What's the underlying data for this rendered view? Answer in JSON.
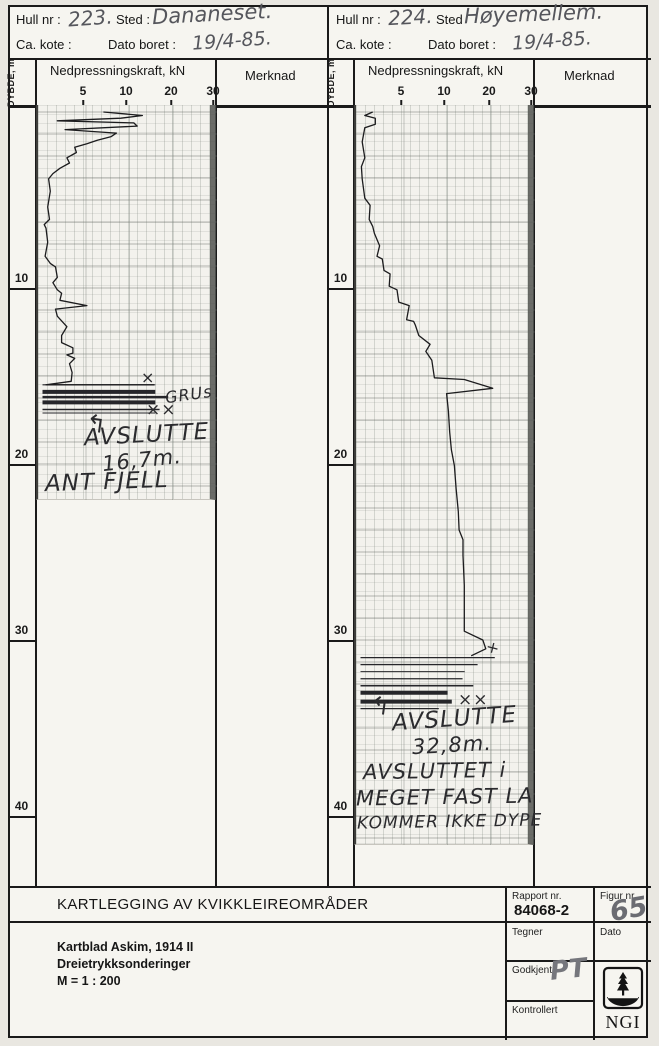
{
  "panels": [
    {
      "hull_nr_label": "Hull nr :",
      "hull_nr": "223.",
      "sted_label": "Sted :",
      "sted": "Dananeset.",
      "kote_label": "Ca. kote :",
      "dato_label": "Dato boret :",
      "dato": "19/4-85.",
      "depth_axis_label": "DYBDE, m",
      "force_label": "Nedpressningskraft, kN",
      "merknad_label": "Merknad",
      "force_ticks": [
        "5",
        "10",
        "20",
        "30"
      ],
      "depth_ticks": [
        "10",
        "20",
        "30",
        "40"
      ],
      "annotations": {
        "mark_x": "×",
        "soil": "GRUs",
        "mark_xx": "××",
        "arrow": "↰",
        "stop_word": "AVSLUTTE",
        "stop_depth": "16,7m.",
        "stop_note": "ANT FJELL"
      }
    },
    {
      "hull_nr_label": "Hull nr :",
      "hull_nr": "224.",
      "sted_label": "Sted",
      "sted": "Høyemellem.",
      "kote_label": "Ca. kote :",
      "dato_label": "Dato boret :",
      "dato": "19/4-85.",
      "depth_axis_label": "DYBDE, m",
      "force_label": "Nedpressningskraft, kN",
      "merknad_label": "Merknad",
      "force_ticks": [
        "5",
        "10",
        "20",
        "30"
      ],
      "depth_ticks": [
        "10",
        "20",
        "30",
        "40"
      ],
      "annotations": {
        "mark_plus": "+",
        "mark_xx": "××",
        "arrow": "↰",
        "stop_word": "AVSLUTTE",
        "stop_depth": "32,8m.",
        "stop_note1": "AVSLUTTET i",
        "stop_note2": "MEGET FAST LA",
        "stop_note3": "KOMMER IKKE DYPE"
      }
    }
  ],
  "chart_data": [
    {
      "type": "line",
      "title": "Dreietrykksondering Hull nr 223 Dananeset",
      "xlabel": "Nedpressningskraft, kN",
      "ylabel": "Dybde, m",
      "x_ticks": [
        5,
        10,
        20,
        30
      ],
      "xlim": [
        0,
        30
      ],
      "ylim": [
        0,
        22
      ],
      "grid": true,
      "points": [
        [
          7,
          0
        ],
        [
          13,
          0.2
        ],
        [
          9,
          0.35
        ],
        [
          1.7,
          0.5
        ],
        [
          11,
          0.62
        ],
        [
          11.8,
          0.8
        ],
        [
          2.6,
          1.0
        ],
        [
          8.5,
          1.2
        ],
        [
          7.9,
          1.4
        ],
        [
          6.3,
          1.6
        ],
        [
          5.1,
          1.8
        ],
        [
          3.7,
          2.0
        ],
        [
          3.9,
          2.3
        ],
        [
          2.8,
          2.6
        ],
        [
          3.1,
          2.9
        ],
        [
          2.0,
          3.2
        ],
        [
          1.2,
          3.5
        ],
        [
          0.7,
          3.8
        ],
        [
          0.9,
          4.5
        ],
        [
          0.6,
          5.4
        ],
        [
          0.8,
          6.1
        ],
        [
          0.2,
          6.4
        ],
        [
          0.4,
          6.6
        ],
        [
          0.6,
          7.4
        ],
        [
          0.3,
          8.2
        ],
        [
          0.9,
          8.6
        ],
        [
          1.5,
          8.8
        ],
        [
          1.7,
          9.4
        ],
        [
          1.2,
          9.7
        ],
        [
          1.7,
          10.1
        ],
        [
          2.2,
          10.3
        ],
        [
          2.0,
          10.7
        ],
        [
          5.1,
          11.0
        ],
        [
          1.5,
          11.2
        ],
        [
          1.7,
          11.6
        ],
        [
          2.8,
          12.2
        ],
        [
          2.2,
          12.7
        ],
        [
          2.2,
          13.1
        ],
        [
          3.5,
          13.4
        ],
        [
          3.5,
          13.7
        ],
        [
          2.8,
          13.8
        ],
        [
          3.7,
          14.0
        ],
        [
          3.1,
          14.3
        ],
        [
          3.4,
          14.8
        ],
        [
          3.3,
          15.3
        ],
        [
          0.4,
          15.5
        ],
        [
          15.7,
          15.5
        ]
      ],
      "hard_layers": [
        {
          "depth": 15.5,
          "kn": 16,
          "w": 1.2
        },
        {
          "depth": 15.9,
          "kn": 16,
          "w": 4
        },
        {
          "depth": 16.2,
          "kn": 19,
          "w": 2.5
        },
        {
          "depth": 16.5,
          "kn": 16,
          "w": 4
        },
        {
          "depth": 16.9,
          "kn": 17,
          "w": 1.5
        },
        {
          "depth": 17.1,
          "kn": 16,
          "w": 1
        }
      ],
      "end_depth_m": 16.7,
      "end_note": "ANT FJELL"
    },
    {
      "type": "line",
      "title": "Dreietrykksondering Hull nr 224 Høyemellem",
      "xlabel": "Nedpressningskraft, kN",
      "ylabel": "Dybde, m",
      "x_ticks": [
        5,
        10,
        20,
        30
      ],
      "xlim": [
        0,
        30
      ],
      "ylim": [
        0,
        42
      ],
      "grid": true,
      "points": [
        [
          1.4,
          0
        ],
        [
          0.5,
          0.2
        ],
        [
          1.7,
          0.35
        ],
        [
          1.7,
          0.7
        ],
        [
          0.5,
          0.9
        ],
        [
          0.2,
          1.7
        ],
        [
          0.5,
          2.6
        ],
        [
          0.1,
          3.1
        ],
        [
          0.2,
          3.8
        ],
        [
          0.5,
          4.9
        ],
        [
          1.1,
          5.3
        ],
        [
          1.0,
          6.1
        ],
        [
          1.4,
          6.5
        ],
        [
          1.6,
          6.9
        ],
        [
          2.2,
          7.6
        ],
        [
          1.9,
          8.2
        ],
        [
          2.5,
          8.35
        ],
        [
          2.7,
          9.0
        ],
        [
          3.4,
          9.2
        ],
        [
          3.3,
          9.9
        ],
        [
          4.2,
          10.1
        ],
        [
          4.4,
          10.8
        ],
        [
          5.6,
          11.0
        ],
        [
          5.3,
          11.8
        ],
        [
          6.1,
          11.9
        ],
        [
          6.3,
          12.1
        ],
        [
          6.7,
          12.7
        ],
        [
          8.0,
          13.2
        ],
        [
          7.5,
          13.6
        ],
        [
          8.2,
          14.1
        ],
        [
          8.5,
          15.1
        ],
        [
          13.9,
          15.2
        ],
        [
          20.5,
          15.7
        ],
        [
          9.9,
          16.0
        ],
        [
          10.2,
          17.0
        ],
        [
          10.5,
          18.2
        ],
        [
          10.9,
          19.2
        ],
        [
          11.6,
          20.1
        ],
        [
          12.0,
          21.4
        ],
        [
          12.5,
          22.7
        ],
        [
          12.7,
          23.75
        ],
        [
          13.6,
          24.3
        ],
        [
          13.6,
          25.2
        ],
        [
          13.9,
          26.9
        ],
        [
          13.9,
          28.4
        ],
        [
          13.9,
          29.5
        ],
        [
          18.2,
          30.0
        ],
        [
          18.9,
          30.5
        ],
        [
          15.5,
          30.9
        ]
      ],
      "hard_layers": [
        {
          "depth": 31.0,
          "kn": 21,
          "w": 1.2
        },
        {
          "depth": 31.4,
          "kn": 17,
          "w": 1.2
        },
        {
          "depth": 31.8,
          "kn": 14,
          "w": 1
        },
        {
          "depth": 32.2,
          "kn": 13.5,
          "w": 1.2
        },
        {
          "depth": 32.6,
          "kn": 16,
          "w": 1.5
        },
        {
          "depth": 33.0,
          "kn": 10,
          "w": 4
        },
        {
          "depth": 33.5,
          "kn": 11,
          "w": 4
        },
        {
          "depth": 33.9,
          "kn": 9,
          "w": 1.2
        }
      ],
      "end_depth_m": 32.8,
      "end_note": "AVSLUTTET i MEGET FAST LAG - KOMMER IKKE DYPERE"
    }
  ],
  "title_block": {
    "title": "KARTLEGGING AV KVIKKLEIREOMRÅDER",
    "line1": "Kartblad Askim, 1914 II",
    "line2": "Dreietrykksonderinger",
    "line3": "M = 1 : 200",
    "rapport_label": "Rapport nr.",
    "rapport_nr": "84068-2",
    "figur_label": "Figur nr.",
    "figur_nr": "65",
    "tegner_label": "Tegner",
    "dato_label": "Dato",
    "godkjent_label": "Godkjent",
    "godkjent_sign": "PT",
    "kontrollert_label": "Kontrollert",
    "logo_text": "NGI"
  }
}
